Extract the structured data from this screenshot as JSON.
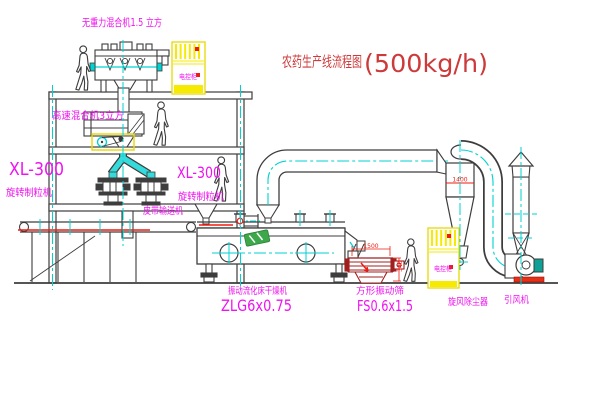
{
  "title": {
    "name_zh": "农药生产线流程图",
    "capacity": "(500kg/h)"
  },
  "equipment_labels": {
    "gravity_free_mixer": "无重力混合机1.5 立方",
    "high_speed_mixer": "高速混合机3立方",
    "granulator_left_model": "XL-300",
    "granulator_left_name": "旋转制粒机",
    "granulator_center_model": "XL-300",
    "granulator_center_name": "旋转制粒机",
    "belt_conveyor": "皮带输送机",
    "fluid_bed_dryer_name": "振动流化床干燥机",
    "fluid_bed_dryer_model": "ZLG6x0.75",
    "square_sieve_name": "方形振动筛",
    "square_sieve_model": "FS0.6x1.5",
    "cyclone_dust_collector": "旋风除尘器",
    "induced_draft_fan": "引风机",
    "control_cabinet_1": "电控柜",
    "control_cabinet_2": "电控柜"
  },
  "dimensions": {
    "sieve_length": "1500",
    "sieve_height": "340",
    "cyclone_marking": "1400"
  },
  "colors": {
    "line_dark": "#3d3d3d",
    "centerline_cyan": "#00d2d2",
    "label_magenta": "#f012f0",
    "title_red": "#cd3a3a",
    "accent_red": "#ed1c11",
    "sieve_red": "#a02020",
    "highlight_yellow": "#f5ea00",
    "logo_green": "#3da84a",
    "motor_teal": "#0fa195"
  }
}
